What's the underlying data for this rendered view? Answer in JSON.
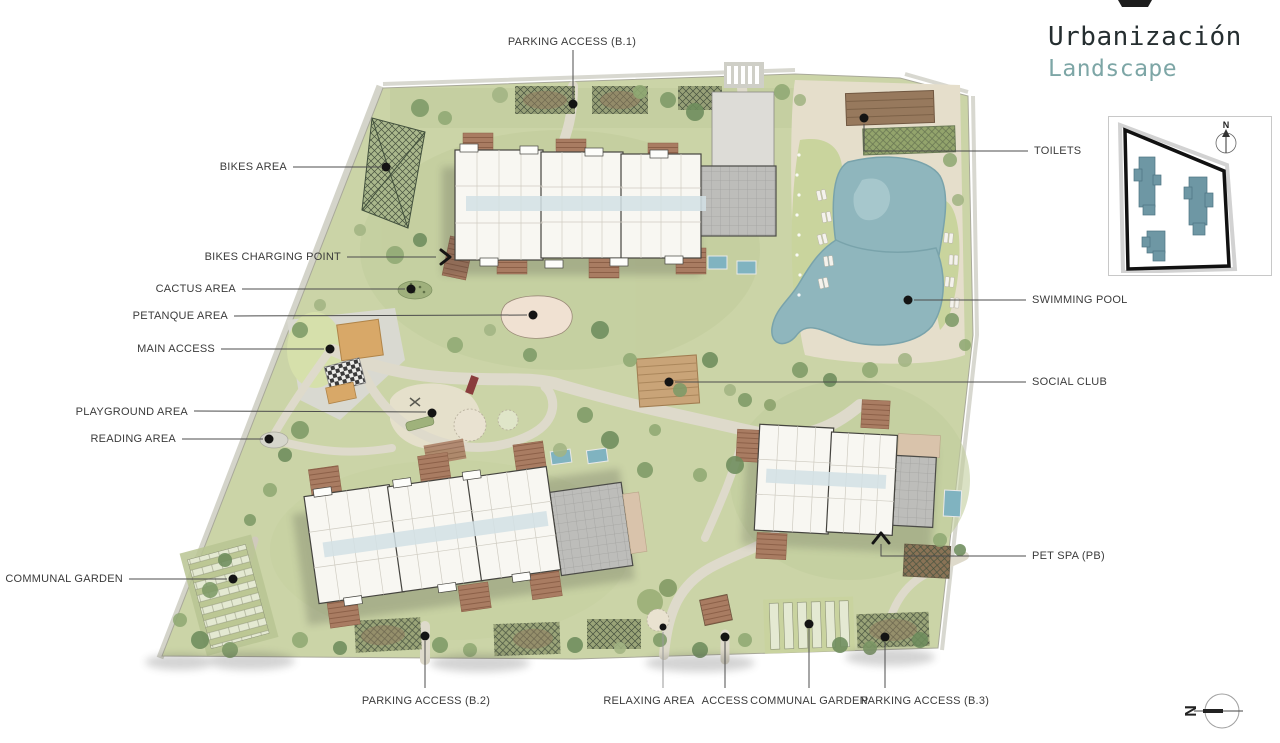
{
  "title": {
    "line1": "Urbanización",
    "line2": "Landscape"
  },
  "labels": {
    "parking_access_b1": "PARKING ACCESS (B.1)",
    "bikes_area": "BIKES AREA",
    "bikes_charging_point": "BIKES CHARGING POINT",
    "cactus_area": "CACTUS AREA",
    "petanque_area": "PETANQUE AREA",
    "main_access": "MAIN ACCESS",
    "playground_area": "PLAYGROUND AREA",
    "reading_area": "READING AREA",
    "communal_garden_left": "COMMUNAL GARDEN",
    "toilets": "TOILETS",
    "swimming_pool": "SWIMMING POOL",
    "social_club": "SOCIAL CLUB",
    "pet_spa": "PET SPA (PB)",
    "parking_access_b2": "PARKING ACCESS (B.2)",
    "relaxing_area": "RELAXING AREA",
    "access": "ACCESS",
    "communal_garden_bottom": "COMMUNAL GARDEN",
    "parking_access_b3": "PARKING ACCESS (B.3)"
  },
  "inset": {
    "north_label": "N"
  },
  "compass": {
    "north_label": "N"
  },
  "colors": {
    "subtitle_teal": "#7da6a6",
    "pool_blue": "#8fb6bd",
    "site_green": "#cbd4a7",
    "deck_terracotta": "#a97c62",
    "inset_building_teal": "#6e97a4",
    "label_ink": "#3b3b3b"
  }
}
